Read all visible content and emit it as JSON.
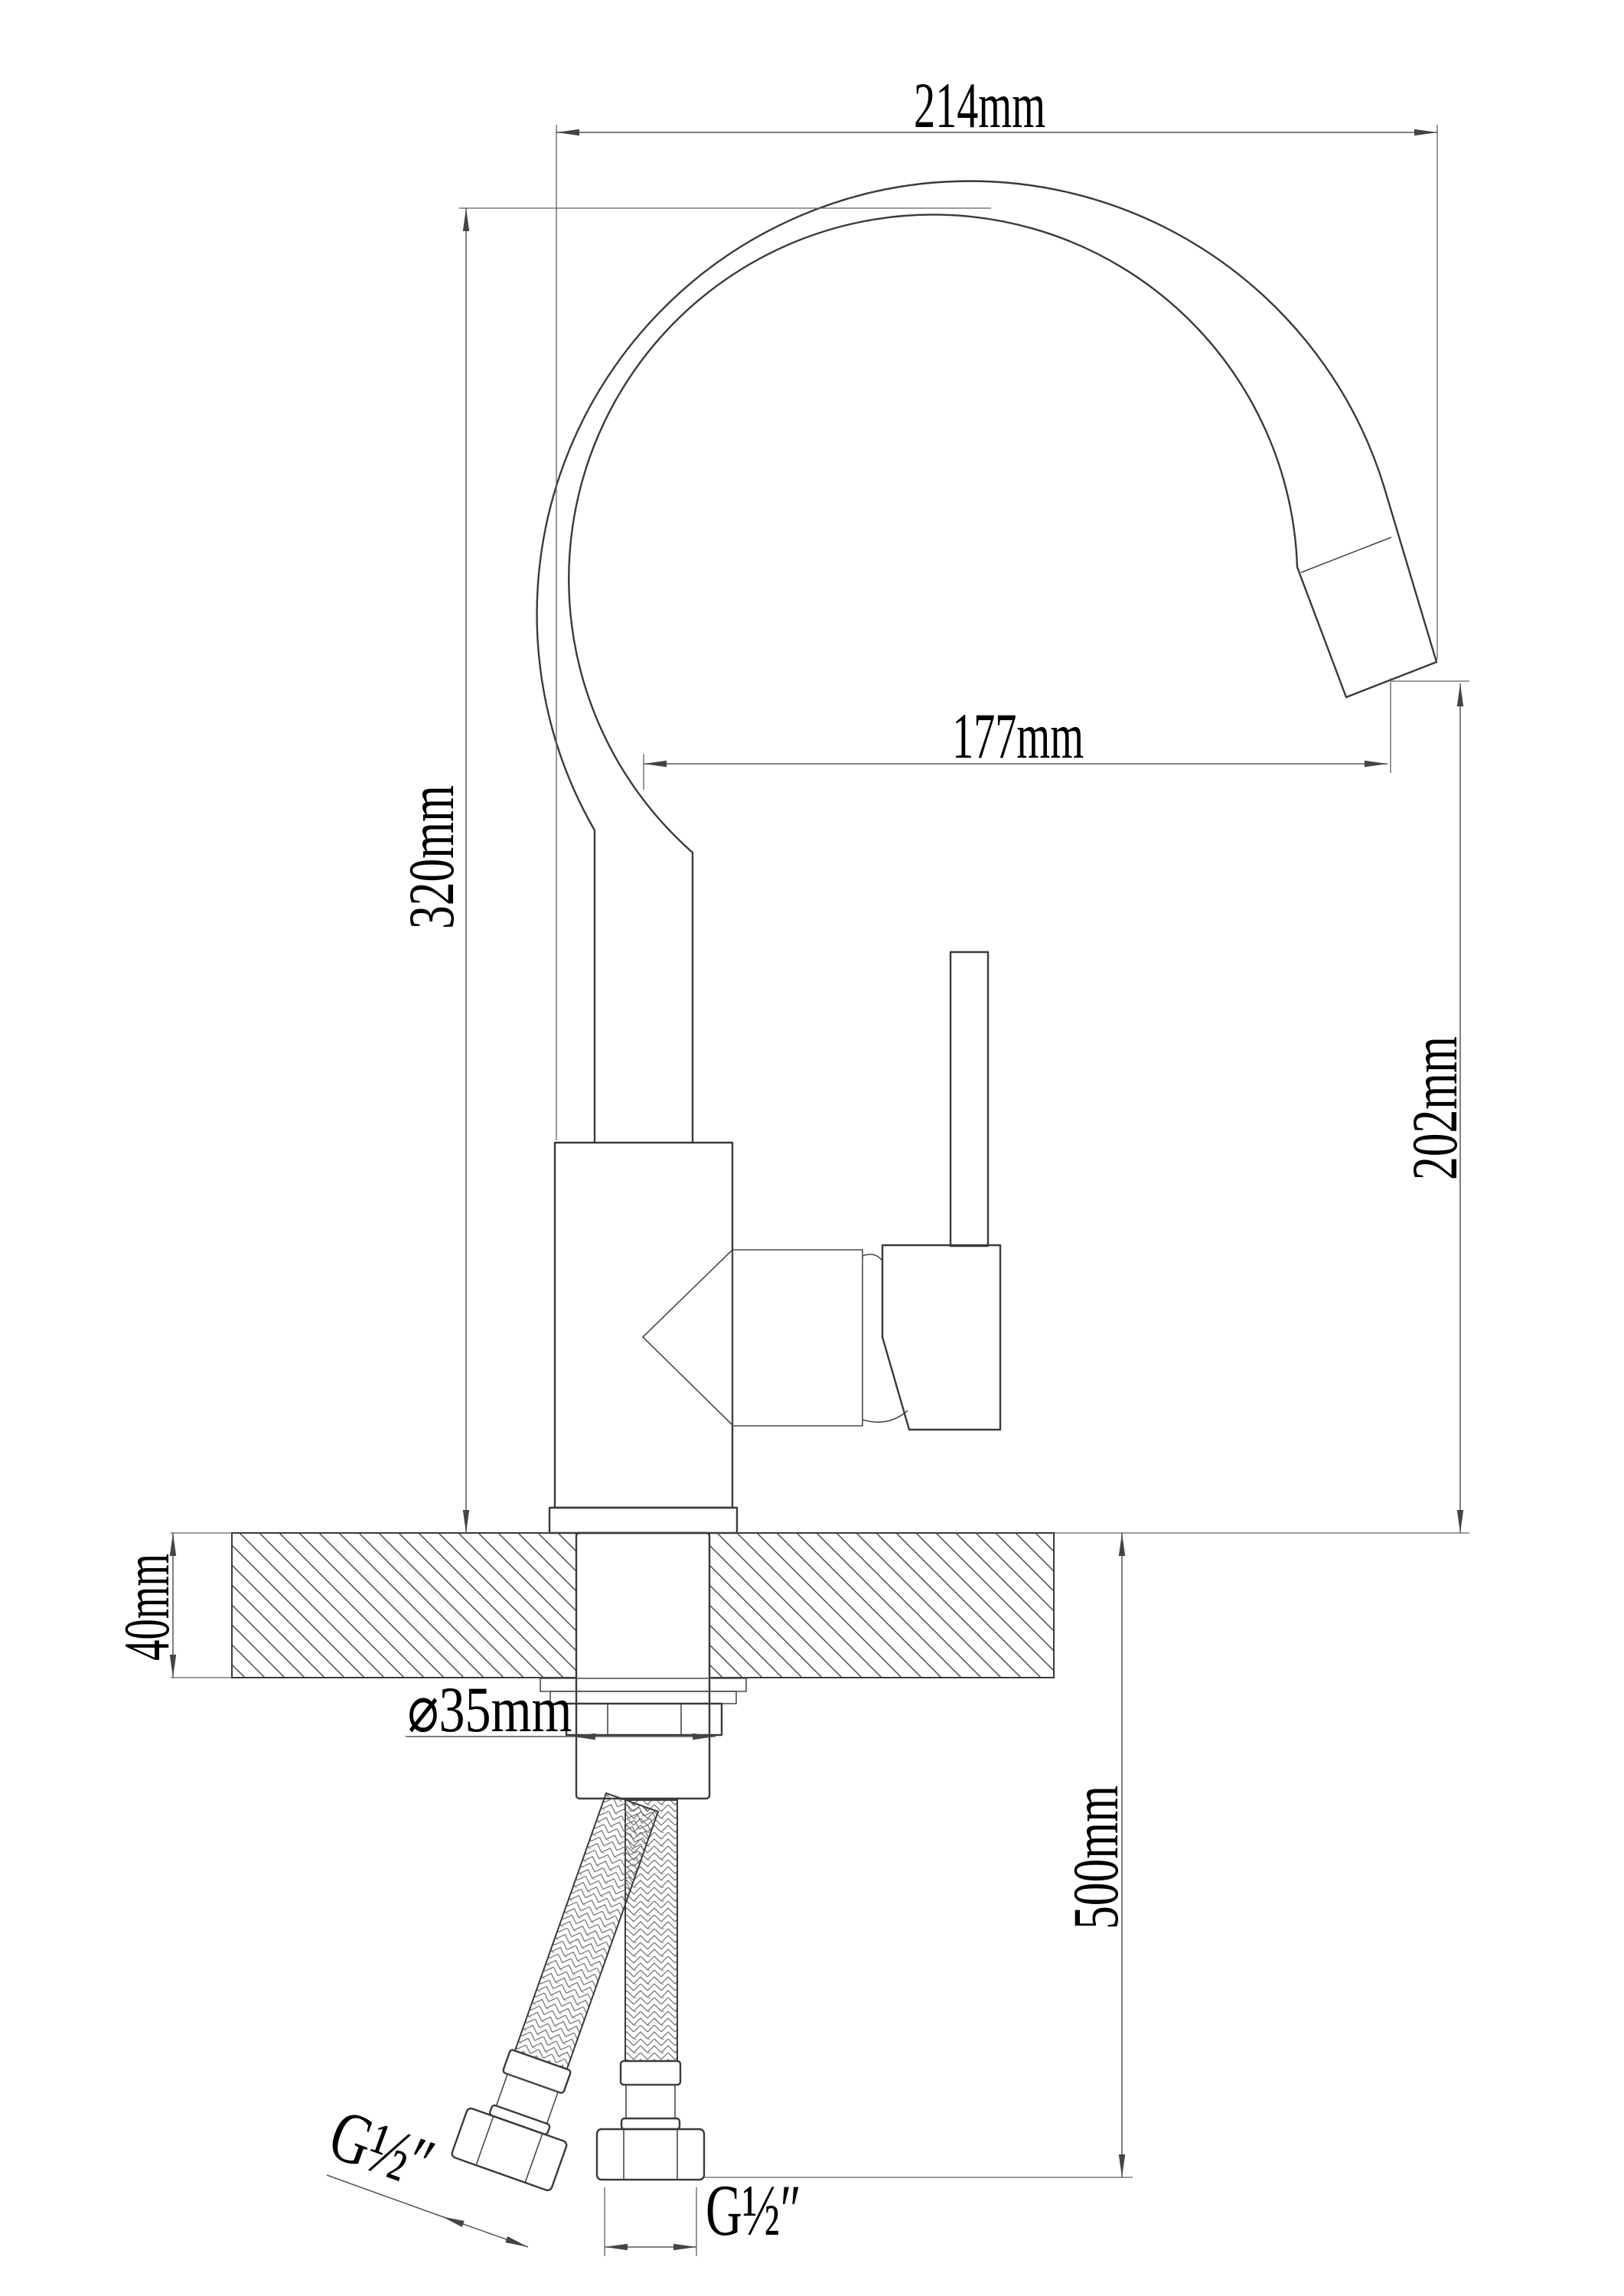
{
  "drawing": {
    "kind": "faucet installation dimension drawing",
    "units": "mm"
  },
  "dimensions": {
    "spout_width_top": "214mm",
    "spout_height": "320mm",
    "spout_reach": "177mm",
    "outlet_height": "202mm",
    "counter_thickness": "40mm",
    "hole_diameter": "⌀35mm",
    "hose_length": "500mm",
    "thread_left": "G½″",
    "thread_bottom": "G½″"
  },
  "colors": {
    "background": "#ffffff",
    "outline_ink": "#3a3a3a",
    "dimension_ink": "#555555",
    "text_ink": "#000000"
  }
}
